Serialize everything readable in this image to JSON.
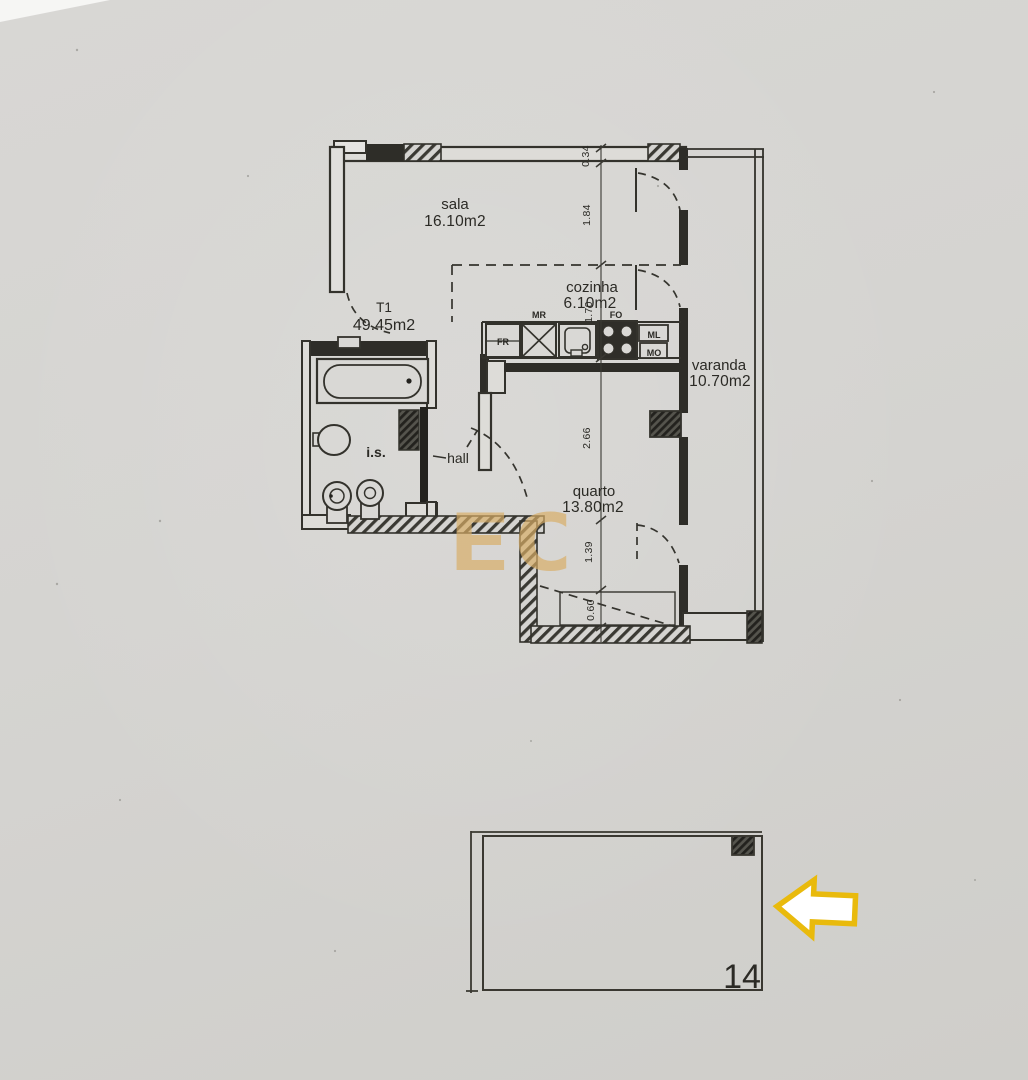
{
  "document": {
    "type": "apartment floor plan (scan)"
  },
  "unit": {
    "label": "T1",
    "area": "49.45m2"
  },
  "rooms": {
    "sala": {
      "name": "sala",
      "area": "16.10m2"
    },
    "cozinha": {
      "name": "cozinha",
      "area": "6.10m2"
    },
    "varanda": {
      "name": "varanda",
      "area": "10.70m2"
    },
    "quarto": {
      "name": "quarto",
      "area": "13.80m2"
    },
    "bathroom": {
      "name": "i.s."
    },
    "hall": {
      "name": "hall"
    }
  },
  "dims": [
    "0.34",
    "1.84",
    "1.70",
    "2.66",
    "1.39",
    "0.60"
  ],
  "kitchen": {
    "fr": "FR",
    "mr": "MR",
    "fo": "FO",
    "ml": "ML",
    "mo": "MO"
  },
  "parking": {
    "space_number": "14"
  },
  "watermark": {
    "text": "EC",
    "color": "#d9ae66"
  },
  "colors": {
    "paper": "#d5d4d1",
    "ink": "#2e2d28",
    "arrow_border": "#e9ba0c",
    "arrow_fill": "#ffffff"
  }
}
